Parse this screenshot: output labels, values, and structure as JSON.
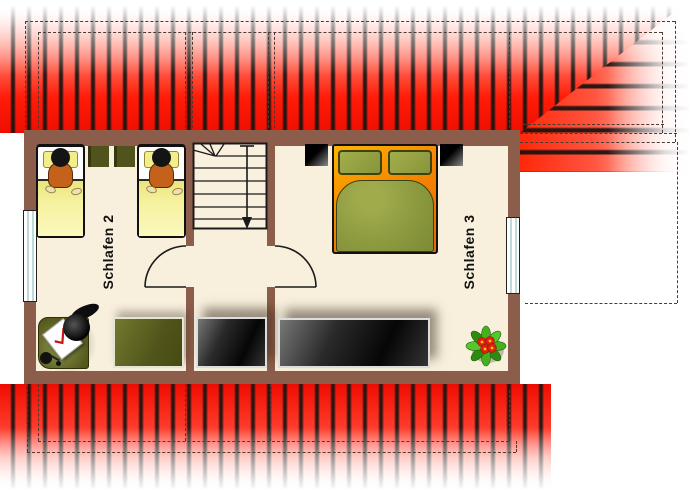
{
  "plan_type": "floor-plan",
  "labels": {
    "room2": "Schlafen 2",
    "room3": "Schlafen 3"
  },
  "rooms": [
    {
      "name": "Schlafen 2",
      "furniture": [
        "single-bed",
        "single-bed",
        "nightstand",
        "nightstand",
        "desk",
        "desk-chair",
        "desk-lamp",
        "paper-sheet",
        "dresser"
      ]
    },
    {
      "name": "Schlafen 3",
      "furniture": [
        "double-bed",
        "nightstand",
        "nightstand",
        "wardrobe",
        "potted-plant"
      ]
    }
  ],
  "hall": {
    "furniture": [
      "staircase-down-arrow",
      "wardrobe"
    ],
    "doors": [
      "door-to-schlafen-2",
      "door-to-schlafen-3"
    ]
  },
  "windows": [
    "left-wall-window",
    "right-wall-window"
  ],
  "palette": {
    "roof_red": "#ff1c08",
    "roof_stripe_dark": "#1c1512",
    "wall_brown": "#8d5d4b",
    "floor_cream": "#f8f0dd",
    "bed_blanket_yellow": "#f3ee8a",
    "person_shirt_orange": "#c4621c",
    "double_bed_orange": "#f68a00",
    "bedding_olive": "#8d9a40",
    "furniture_olive": "#51551a",
    "wardrobe_dark": "#141414",
    "window_glass_blue": "#bcdcdc",
    "plant_leaf_green": "#46b01e",
    "flower_red": "#dd2012"
  }
}
